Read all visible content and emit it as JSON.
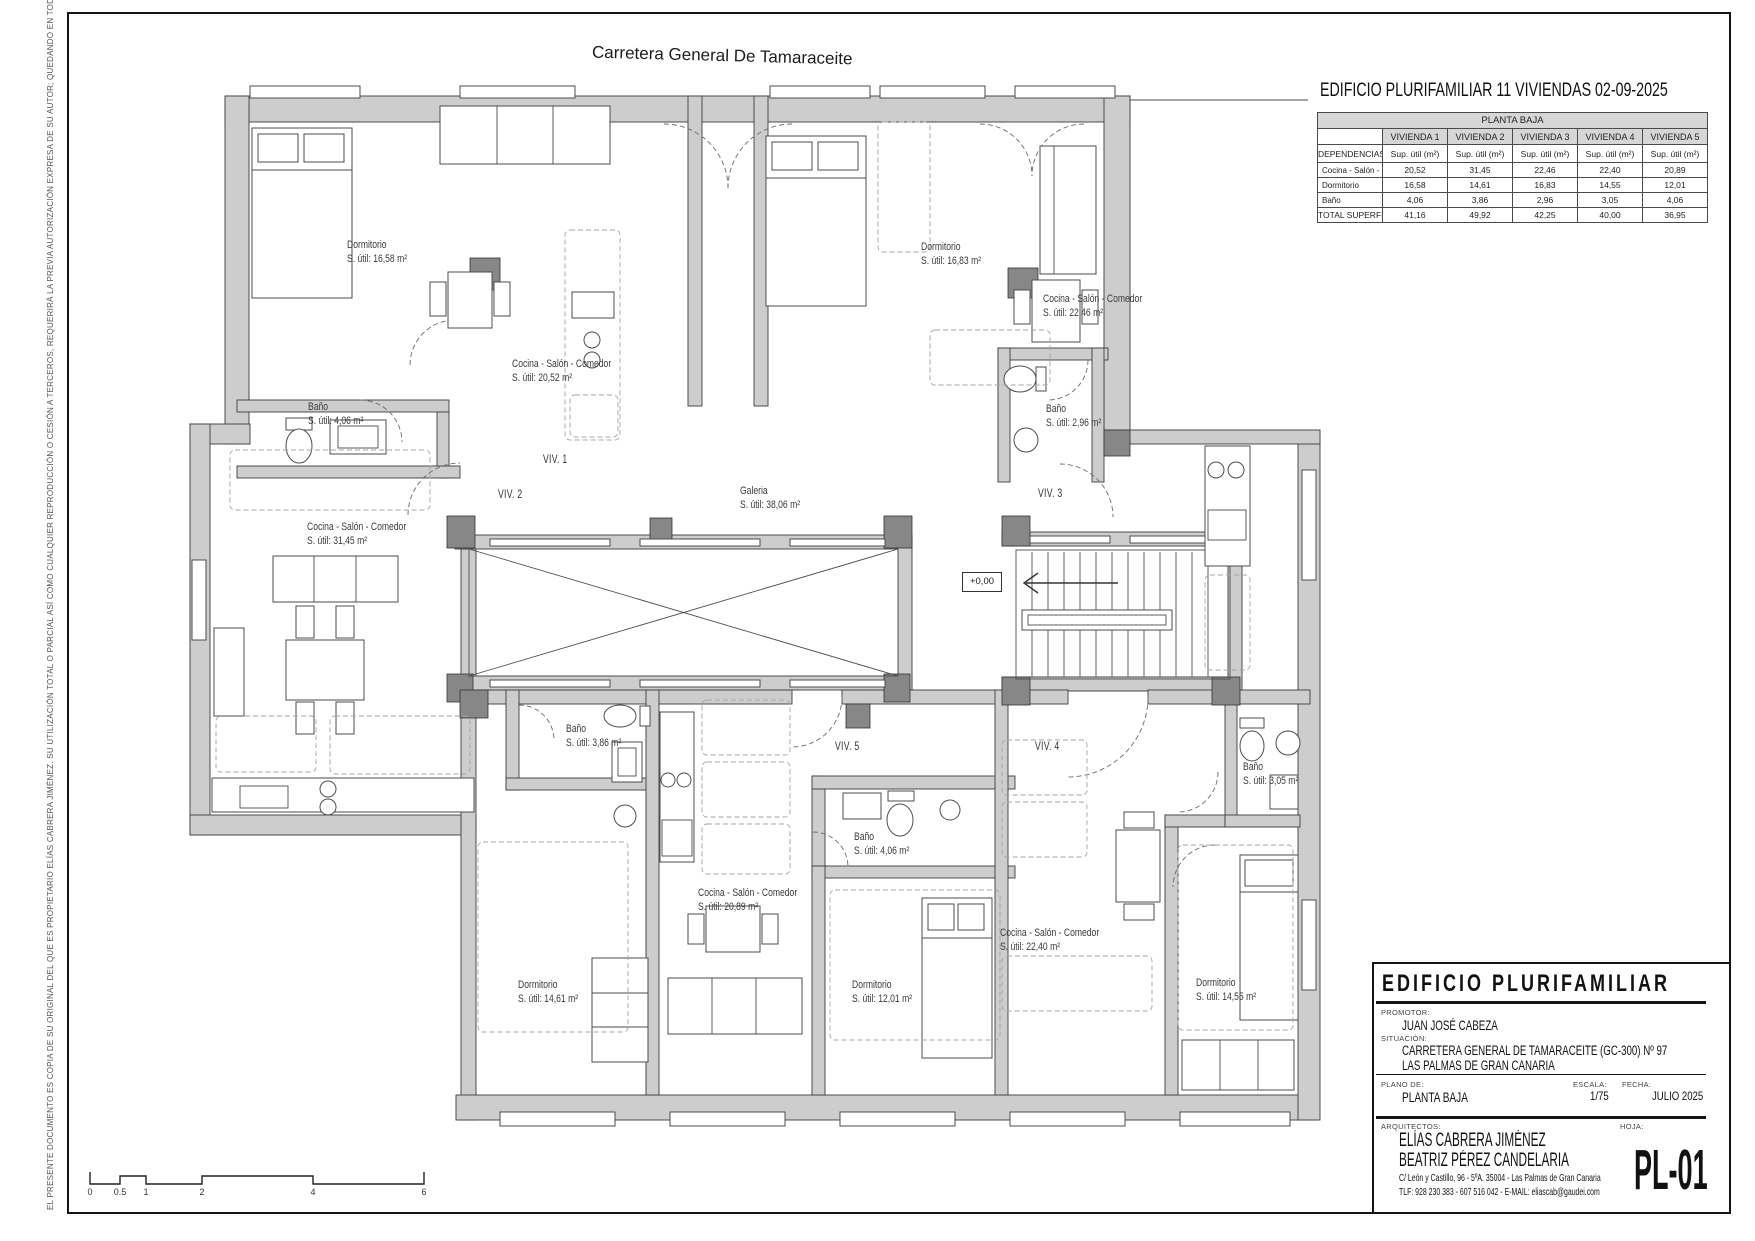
{
  "sheet": {
    "street_label": "Carretera General De Tamaraceite",
    "header_title": "EDIFICIO PLURIFAMILIAR 11 VIVIENDAS 02-09-2025",
    "copyright_note": "EL PRESENTE DOCUMENTO ES COPIA DE SU ORIGINAL DEL QUE ES PROPIETARIO ELÍAS CABRERA JIMÉNEZ. SU UTILIZACIÓN TOTAL O PARCIAL ASÍ COMO CUALQUIER REPRODUCCIÓN O CESIÓN A TERCEROS, REQUERIRÁ LA PREVIA AUTORIZACIÓN EXPRESA DE SU AUTOR; QUEDANDO EN TODO CASO PROHIBIDA CUALQUIER MODIFICACIÓN UNILATERAL DEL MISMO."
  },
  "area_table": {
    "title": "PLANTA BAJA",
    "dependencias_header": "DEPENDENCIAS",
    "sup_util_header": "Sup. útil (m²)",
    "unit_headers": [
      "VIVIENDA 1",
      "VIVIENDA 2",
      "VIVIENDA 3",
      "VIVIENDA 4",
      "VIVIENDA 5"
    ],
    "rows": [
      {
        "label": "Cocina - Salón - Comedor",
        "values": [
          "20,52",
          "31,45",
          "22,46",
          "22,40",
          "20,89"
        ]
      },
      {
        "label": "Dormitorio",
        "values": [
          "16,58",
          "14,61",
          "16,83",
          "14,55",
          "12,01"
        ]
      },
      {
        "label": "Baño",
        "values": [
          "4,06",
          "3,86",
          "2,96",
          "3,05",
          "4,06"
        ]
      }
    ],
    "total": {
      "label": "TOTAL SUPERFICIE ÚTIL",
      "values": [
        "41,16",
        "49,92",
        "42,25",
        "40,00",
        "36,95"
      ]
    }
  },
  "plan": {
    "level_marker": "+0,00",
    "unit_labels": [
      "VIV. 1",
      "VIV. 2",
      "VIV. 3",
      "VIV. 4",
      "VIV. 5"
    ],
    "rooms": [
      {
        "name": "Dormitorio",
        "area": "S. útil: 16,58 m²"
      },
      {
        "name": "Cocina - Salón - Comedor",
        "area": "S. útil: 20,52 m²"
      },
      {
        "name": "Baño",
        "area": "S. útil: 4,06 m²"
      },
      {
        "name": "Dormitorio",
        "area": "S. útil: 16,83 m²"
      },
      {
        "name": "Cocina - Salón - Comedor",
        "area": "S. útil: 22,46 m²"
      },
      {
        "name": "Baño",
        "area": "S. útil: 2,96 m²"
      },
      {
        "name": "Cocina - Salón - Comedor",
        "area": "S. útil: 31,45 m²"
      },
      {
        "name": "Galeria",
        "area": "S. útil: 38,06 m²"
      },
      {
        "name": "Baño",
        "area": "S. útil: 3,86 m²"
      },
      {
        "name": "Cocina - Salón - Comedor",
        "area": "S. útil: 20,89 m²"
      },
      {
        "name": "Baño",
        "area": "S. útil: 4,06 m²"
      },
      {
        "name": "Cocina - Salón - Comedor",
        "area": "S. útil: 22,40 m²"
      },
      {
        "name": "Dormitorio",
        "area": "S. útil: 14,61 m²"
      },
      {
        "name": "Dormitorio",
        "area": "S. útil: 12,01 m²"
      },
      {
        "name": "Dormitorio",
        "area": "S. útil: 14,55 m²"
      },
      {
        "name": "Baño",
        "area": "S. útil: 3,05 m²"
      }
    ]
  },
  "scale_bar": {
    "ticks": [
      "0",
      "0.5",
      "1",
      "2",
      "4",
      "6"
    ]
  },
  "title_block": {
    "project": "EDIFICIO PLURIFAMILIAR",
    "promotor_label": "PROMOTOR:",
    "promotor": "JUAN JOSÉ CABEZA",
    "situacion_label": "SITUACIÓN:",
    "situacion_line1": "CARRETERA GENERAL DE TAMARACEITE (GC-300) Nº 97",
    "situacion_line2": "LAS PALMAS DE GRAN CANARIA",
    "plano_label": "PLANO DE:",
    "plano": "PLANTA BAJA",
    "escala_label": "ESCALA:",
    "escala": "1/75",
    "fecha_label": "FECHA:",
    "fecha": "JULIO 2025",
    "arquitectos_label": "ARQUITECTOS:",
    "arquitecto1": "ELÍAS CABRERA JIMÉNEZ",
    "arquitecto2": "BEATRIZ PÉREZ CANDELARIA",
    "address": "C/ León y Castillo, 96 - 5ºA. 35004 - Las Palmas de Gran Canaria",
    "contact": "TLF: 928 230 383 - 607 516 042  -  E-MAIL: eliascab@gaudei.com",
    "hoja_label": "HOJA:",
    "hoja": "PL-01"
  }
}
